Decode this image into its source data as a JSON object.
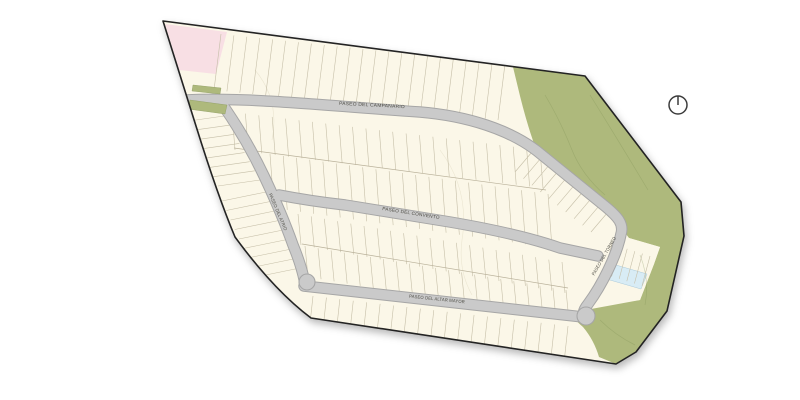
{
  "page": {
    "background": "#FFFFFF"
  },
  "map": {
    "colors": {
      "boundary": "#232323",
      "lot_fill": "#FBF7E8",
      "lot_line": "#C6BFA8",
      "block_line": "#B9B19A",
      "road_fill": "#CACACA",
      "road_edge": "#A6A6A6",
      "green": "#AEB97C",
      "green_line": "#7E9054",
      "pink": "#F8DFE4",
      "pond": "#D8ECF5",
      "label": "#4E4D45",
      "compass": "#3C3C3C"
    },
    "streets": [
      {
        "id": "campanario",
        "label": "PASEO DEL CAMPANARIO"
      },
      {
        "id": "convento",
        "label": "PASEO DEL CONVENTO"
      },
      {
        "id": "altar-mayor",
        "label": "PASEO DEL ALTAR MAYOR"
      },
      {
        "id": "atrio",
        "label": "PASEO DEL ATRIO"
      },
      {
        "id": "torneo",
        "label": "PASEO DEL TORNEO"
      }
    ],
    "compass": {
      "name": "north-indicator"
    }
  }
}
